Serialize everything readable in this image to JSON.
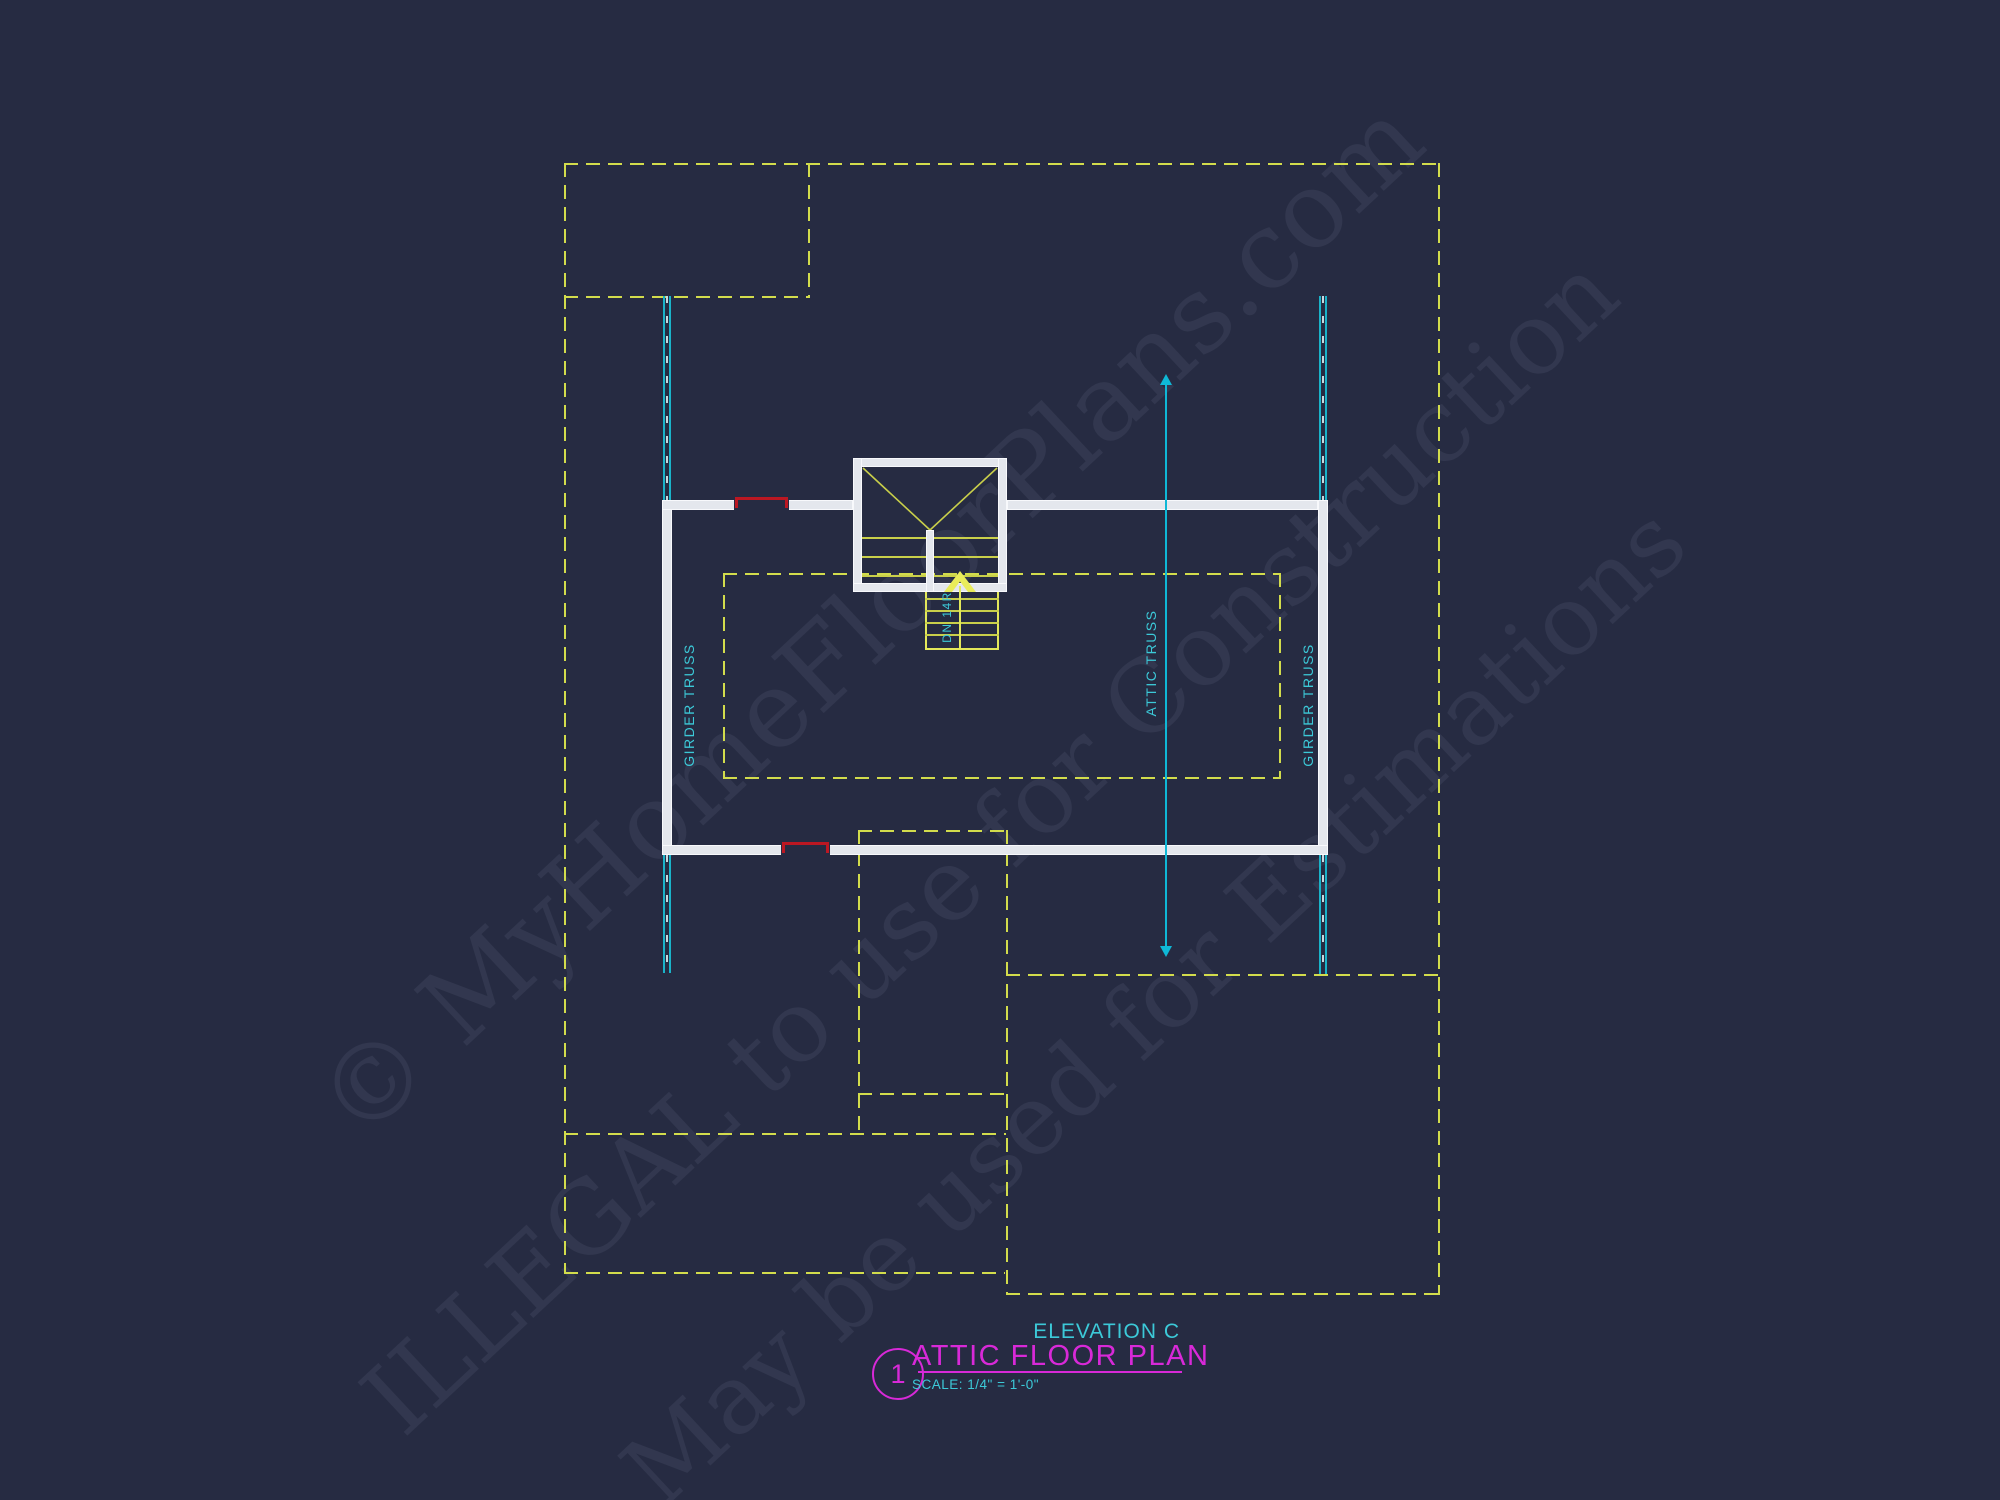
{
  "watermark": {
    "line1": "© MyHomeFloorPlans.com",
    "line2": "ILLEGAL to use for Construction",
    "line3": "May be used for Estimations"
  },
  "plan": {
    "girder_truss_left": "GIRDER TRUSS",
    "girder_truss_right": "GIRDER TRUSS",
    "attic_truss": "ATTIC TRUSS",
    "stair_note": "DN 14R"
  },
  "title_block": {
    "elevation": "ELEVATION C",
    "title": "ATTIC FLOOR PLAN",
    "sheet_number": "1",
    "scale": "SCALE: 1/4\" = 1'-0\""
  },
  "colors": {
    "background": "#262b42",
    "dashed_outline_yellow": "#d2dc4c",
    "wall_white": "#e4e7ed",
    "truss_cyan": "#1ab3c9",
    "label_cyan": "#3cc9d8",
    "title_magenta": "#d829d8",
    "opening_red": "#bb1722",
    "stair_yellow": "#e3e85a",
    "watermark_gray": "rgba(198,210,248,0.08)"
  }
}
